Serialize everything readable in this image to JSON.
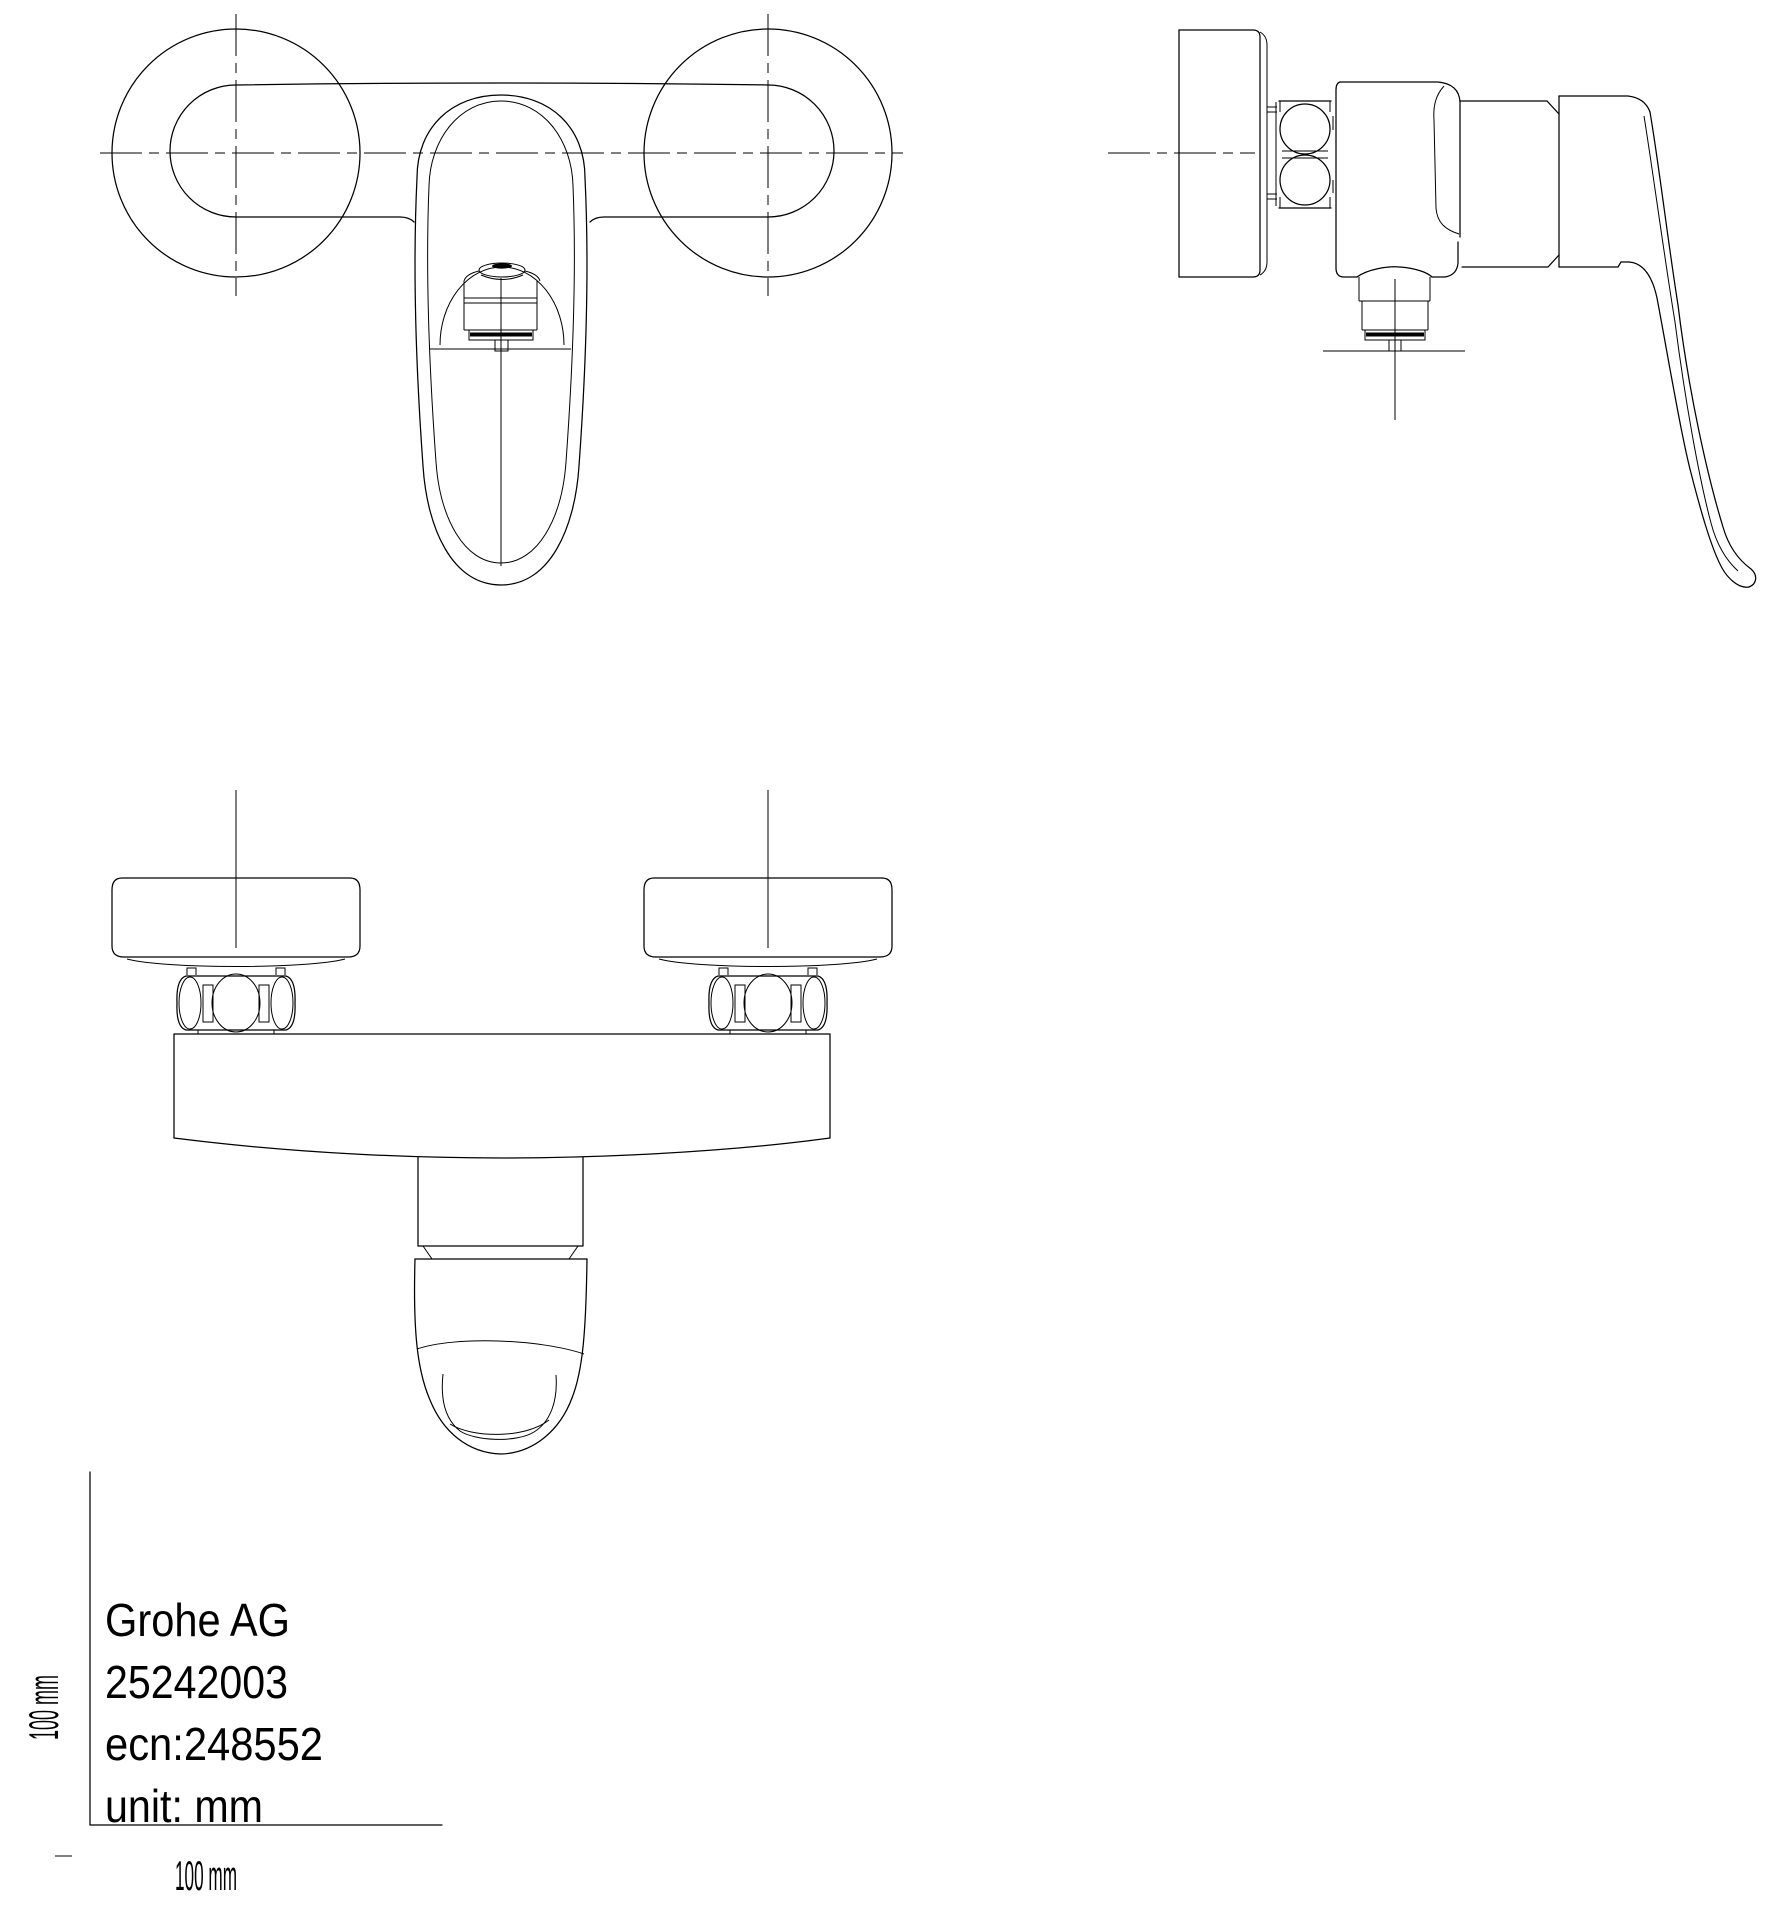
{
  "title_block": {
    "manufacturer": "Grohe AG",
    "product_number": "25242003",
    "ecn": "ecn:248552",
    "unit": "unit: mm"
  },
  "scale": {
    "x_label": "100 mm",
    "y_label": "100 mm"
  },
  "colors": {
    "line": "#000000",
    "background": "#ffffff"
  }
}
